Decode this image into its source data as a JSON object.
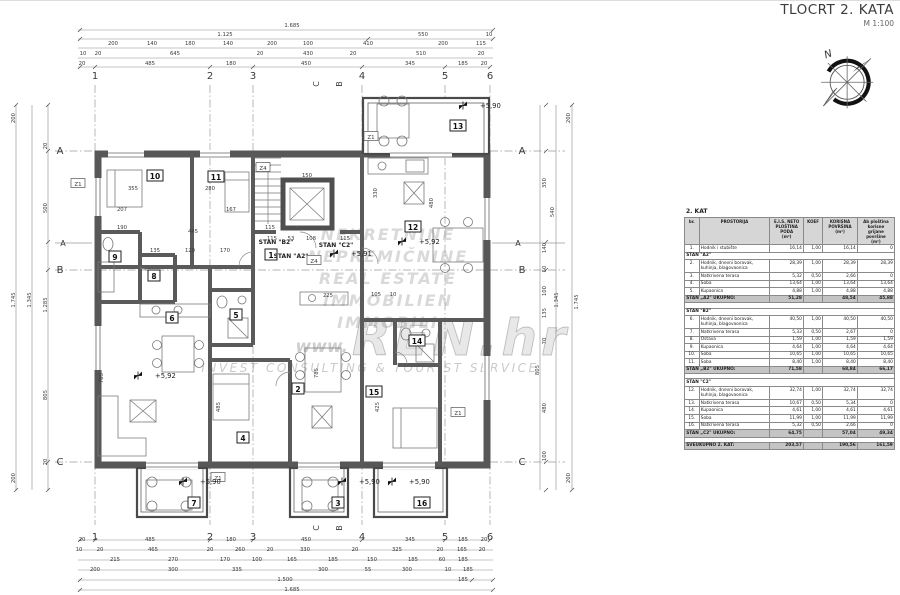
{
  "title": {
    "main": "TLOCRT 2. KATA",
    "scale": "M 1:100"
  },
  "compass": {
    "north": "N"
  },
  "watermark": {
    "languages": [
      "NEKRETNINE",
      "NEPREMIČNINE",
      "REAL ESTATE",
      "IMMOBILIEN",
      "IMMOBILI"
    ],
    "url_prefix": "www.",
    "url_big": "REN.hr",
    "tagline": "INVEST CONSULTING & TOURIST SERVICE"
  },
  "table": {
    "floor_label": "2. KAT",
    "columns": [
      "br.",
      "PROSTORIJA",
      "E.I.S. NETO\nPLOŠTINA\nPODA\n(m²)",
      "KOEF",
      "KORISNA\nPOVRŠINA\n(m²)",
      "Ab ploština\nkorisne grijane\npovršine\n(m²)"
    ],
    "rows": [
      {
        "type": "row",
        "num": "1.",
        "name": "Hodnik i stubište",
        "neto": "16,14",
        "koef": "1,00",
        "korisna": "16,14",
        "grijana": "0"
      },
      {
        "type": "sect",
        "label": "STAN \"A2\""
      },
      {
        "type": "row",
        "num": "2.",
        "name": "Hodnik, dnevni boravak,\nkuhinja, blagovaonica",
        "neto": "28,39",
        "koef": "1,00",
        "korisna": "28,39",
        "grijana": "28,39"
      },
      {
        "type": "row",
        "num": "3.",
        "name": "Natkrivena terasa",
        "neto": "5,32",
        "koef": "0,50",
        "korisna": "2,66",
        "grijana": "0"
      },
      {
        "type": "row",
        "num": "4.",
        "name": "Soba",
        "neto": "13,64",
        "koef": "1,00",
        "korisna": "13,64",
        "grijana": "13,64"
      },
      {
        "type": "row",
        "num": "5.",
        "name": "Kupaonica",
        "neto": "4,88",
        "koef": "1,00",
        "korisna": "4,88",
        "grijana": "4,88"
      },
      {
        "type": "tot",
        "label": "STAN „A2\" UKUPNO:",
        "neto": "51,28",
        "korisna": "48,54",
        "grijana": "45,88"
      },
      {
        "type": "sp"
      },
      {
        "type": "sect",
        "label": "STAN \"B2\""
      },
      {
        "type": "row",
        "num": "6.",
        "name": "Hodnik, dnevni boravak,\nkuhinja, blagovaonica",
        "neto": "40,50",
        "koef": "1,00",
        "korisna": "40,50",
        "grijana": "40,50"
      },
      {
        "type": "row",
        "num": "7.",
        "name": "Natkrivena terasa",
        "neto": "5,33",
        "koef": "0,50",
        "korisna": "2,67",
        "grijana": "0"
      },
      {
        "type": "row",
        "num": "8.",
        "name": "Ostava",
        "neto": "1,59",
        "koef": "1,00",
        "korisna": "1,59",
        "grijana": "1,59"
      },
      {
        "type": "row",
        "num": "9.",
        "name": "Kupaonica",
        "neto": "4,64",
        "koef": "1,00",
        "korisna": "4,64",
        "grijana": "4,64"
      },
      {
        "type": "row",
        "num": "10.",
        "name": "Soba",
        "neto": "10,65",
        "koef": "1,00",
        "korisna": "10,65",
        "grijana": "10,65"
      },
      {
        "type": "row",
        "num": "11.",
        "name": "Soba",
        "neto": "8,40",
        "koef": "1,00",
        "korisna": "8,40",
        "grijana": "8,40"
      },
      {
        "type": "tot",
        "label": "STAN „B2\" UKUPNO:",
        "neto": "71,58",
        "korisna": "68,84",
        "grijana": "66,17"
      },
      {
        "type": "sp"
      },
      {
        "type": "sect",
        "label": "STAN \"C2\""
      },
      {
        "type": "row",
        "num": "12.",
        "name": "Hodnik, dnevni boravak,\nkuhinja, blagovaonica",
        "neto": "32,74",
        "koef": "1,00",
        "korisna": "32,74",
        "grijana": "32,74"
      },
      {
        "type": "row",
        "num": "13.",
        "name": "Natkrivena terasa",
        "neto": "10,67",
        "koef": "0,50",
        "korisna": "5,34",
        "grijana": "0"
      },
      {
        "type": "row",
        "num": "14.",
        "name": "Kupaonica",
        "neto": "4,61",
        "koef": "1,00",
        "korisna": "4,61",
        "grijana": "4,61"
      },
      {
        "type": "row",
        "num": "15.",
        "name": "Soba",
        "neto": "11,99",
        "koef": "1,00",
        "korisna": "11,99",
        "grijana": "11,99"
      },
      {
        "type": "row",
        "num": "16.",
        "name": "Natkrivena terasa",
        "neto": "5,32",
        "koef": "0,50",
        "korisna": "2,66",
        "grijana": "0"
      },
      {
        "type": "tot",
        "label": "STAN „C2\" UKUPNO:",
        "neto": "64,75",
        "korisna": "57,04",
        "grijana": "49,34"
      },
      {
        "type": "sp"
      },
      {
        "type": "grand",
        "label": "SVEUKUPNO 2. KAT:",
        "neto": "203,57",
        "korisna": "190,56",
        "grijana": "161,59"
      }
    ]
  },
  "plan": {
    "grid": {
      "cols": [
        [
          "1",
          95
        ],
        [
          "2",
          210
        ],
        [
          "3",
          253
        ],
        [
          "4",
          362
        ],
        [
          "5",
          445
        ],
        [
          "6",
          490
        ]
      ],
      "rows": [
        [
          "A",
          151
        ],
        [
          "B",
          270
        ],
        [
          "C",
          462
        ]
      ],
      "col_label_y_top": 79,
      "col_label_y_bottom": 532,
      "row_label_x_left": 60,
      "row_label_x_right": 522,
      "section_row": [
        "A",
        243
      ],
      "section_cols": [
        [
          "C",
          319
        ],
        [
          "B",
          342
        ]
      ],
      "section_col_y_top": 84,
      "section_col_y_bottom": 528
    },
    "dim_labels": [
      [
        "1.685",
        292,
        27
      ],
      [
        "1.125",
        225,
        36
      ],
      [
        "550",
        423,
        36
      ],
      [
        "10",
        489,
        36
      ],
      [
        "200",
        113,
        45
      ],
      [
        "140",
        152,
        45
      ],
      [
        "180",
        190,
        45
      ],
      [
        "140",
        228,
        45
      ],
      [
        "200",
        272,
        45
      ],
      [
        "100",
        308,
        45
      ],
      [
        "410",
        368,
        45
      ],
      [
        "200",
        443,
        45
      ],
      [
        "115",
        481,
        45
      ],
      [
        "10",
        83,
        55
      ],
      [
        "20",
        98,
        55
      ],
      [
        "645",
        175,
        55
      ],
      [
        "20",
        260,
        55
      ],
      [
        "430",
        308,
        55
      ],
      [
        "20",
        353,
        55
      ],
      [
        "510",
        421,
        55
      ],
      [
        "20",
        481,
        55
      ],
      [
        "20",
        82,
        65
      ],
      [
        "485",
        150,
        65
      ],
      [
        "180",
        231,
        65
      ],
      [
        "450",
        306,
        65
      ],
      [
        "345",
        410,
        65
      ],
      [
        "185",
        463,
        65
      ],
      [
        "20",
        484,
        65
      ],
      [
        "20",
        82,
        541
      ],
      [
        "485",
        150,
        541
      ],
      [
        "180",
        231,
        541
      ],
      [
        "450",
        306,
        541
      ],
      [
        "345",
        410,
        541
      ],
      [
        "185",
        463,
        541
      ],
      [
        "20",
        484,
        541
      ],
      [
        "10",
        79,
        551
      ],
      [
        "20",
        100,
        551
      ],
      [
        "465",
        153,
        551
      ],
      [
        "20",
        210,
        551
      ],
      [
        "260",
        240,
        551
      ],
      [
        "20",
        270,
        551
      ],
      [
        "330",
        305,
        551
      ],
      [
        "20",
        355,
        551
      ],
      [
        "325",
        397,
        551
      ],
      [
        "20",
        440,
        551
      ],
      [
        "165",
        462,
        551
      ],
      [
        "20",
        482,
        551
      ],
      [
        "215",
        115,
        561
      ],
      [
        "270",
        173,
        561
      ],
      [
        "170",
        225,
        561
      ],
      [
        "100",
        257,
        561
      ],
      [
        "165",
        292,
        561
      ],
      [
        "185",
        333,
        561
      ],
      [
        "150",
        372,
        561
      ],
      [
        "185",
        413,
        561
      ],
      [
        "60",
        442,
        561
      ],
      [
        "185",
        463,
        561
      ],
      [
        "200",
        95,
        571
      ],
      [
        "300",
        173,
        571
      ],
      [
        "335",
        237,
        571
      ],
      [
        "300",
        323,
        571
      ],
      [
        "55",
        368,
        571
      ],
      [
        "300",
        407,
        571
      ],
      [
        "10",
        448,
        571
      ],
      [
        "185",
        468,
        571
      ],
      [
        "1.500",
        285,
        581
      ],
      [
        "185",
        463,
        581
      ],
      [
        "1.685",
        292,
        591
      ],
      [
        "200",
        15,
        118,
        -90
      ],
      [
        "1.745",
        15,
        300,
        -90
      ],
      [
        "200",
        15,
        478,
        -90
      ],
      [
        "1.345",
        31,
        300,
        -90
      ],
      [
        "20",
        47,
        146,
        -90
      ],
      [
        "500",
        47,
        208,
        -90
      ],
      [
        "1.285",
        47,
        305,
        -90
      ],
      [
        "805",
        47,
        395,
        -90
      ],
      [
        "20",
        47,
        462,
        -90
      ],
      [
        "200",
        570,
        118,
        -90
      ],
      [
        "1.745",
        578,
        302,
        -90
      ],
      [
        "200",
        570,
        478,
        -90
      ],
      [
        "1.345",
        558,
        300,
        -90
      ],
      [
        "350",
        546,
        183,
        -90
      ],
      [
        "540",
        554,
        212,
        -90
      ],
      [
        "140",
        546,
        248,
        -90
      ],
      [
        "50",
        546,
        269,
        -90
      ],
      [
        "100",
        546,
        291,
        -90
      ],
      [
        "135",
        546,
        313,
        -90
      ],
      [
        "70",
        546,
        341,
        -90
      ],
      [
        "805",
        539,
        370,
        -90
      ],
      [
        "480",
        546,
        408,
        -90
      ],
      [
        "100",
        546,
        456,
        -90
      ],
      [
        "355",
        133,
        190
      ],
      [
        "207",
        122,
        211
      ],
      [
        "280",
        210,
        190
      ],
      [
        "167",
        231,
        211
      ],
      [
        "190",
        122,
        229
      ],
      [
        "135",
        155,
        252
      ],
      [
        "120",
        190,
        252
      ],
      [
        "170",
        225,
        252
      ],
      [
        "115",
        270,
        229
      ],
      [
        "445",
        193,
        233
      ],
      [
        "150",
        307,
        177
      ],
      [
        "115",
        272,
        240
      ],
      [
        "53",
        291,
        240
      ],
      [
        "108",
        311,
        240
      ],
      [
        "115",
        345,
        240
      ],
      [
        "330",
        377,
        193,
        -90
      ],
      [
        "480",
        433,
        203,
        -90
      ],
      [
        "425",
        379,
        407,
        -90
      ],
      [
        "485",
        220,
        407,
        -90
      ],
      [
        "705",
        103,
        378,
        -90
      ],
      [
        "785",
        318,
        373,
        -90
      ],
      [
        "225",
        328,
        297
      ],
      [
        "105",
        376,
        296
      ],
      [
        "10",
        393,
        296
      ]
    ],
    "room_badges": [
      [
        "1",
        271,
        255
      ],
      [
        "2",
        298,
        389
      ],
      [
        "3",
        338,
        503
      ],
      [
        "4",
        243,
        438
      ],
      [
        "5",
        236,
        315
      ],
      [
        "6",
        172,
        318
      ],
      [
        "7",
        194,
        503
      ],
      [
        "8",
        154,
        276
      ],
      [
        "9",
        115,
        257
      ],
      [
        "10",
        155,
        176
      ],
      [
        "11",
        216,
        177
      ],
      [
        "12",
        413,
        227
      ],
      [
        "13",
        458,
        126
      ],
      [
        "14",
        417,
        341
      ],
      [
        "15",
        374,
        392
      ],
      [
        "16",
        422,
        503
      ]
    ],
    "z_labels": [
      [
        "Z1",
        78,
        184
      ],
      [
        "Z4",
        263,
        168
      ],
      [
        "Z1",
        371,
        137
      ],
      [
        "Z4",
        314,
        261
      ],
      [
        "Z1",
        458,
        413
      ],
      [
        "Z1",
        218,
        478
      ]
    ],
    "stan_labels": [
      [
        "STAN \"B2\"",
        276,
        244
      ],
      [
        "STAN \"C2\"",
        336,
        247
      ],
      [
        "STAN \"A2\"",
        291,
        258
      ]
    ],
    "elevations": [
      [
        "+5,92",
        148,
        378
      ],
      [
        "+5,92",
        412,
        244
      ],
      [
        "+5,91",
        344,
        256
      ],
      [
        "+5,90",
        473,
        108
      ],
      [
        "+5,90",
        193,
        484
      ],
      [
        "+5,90",
        352,
        484
      ],
      [
        "+5,90",
        402,
        484
      ]
    ]
  }
}
